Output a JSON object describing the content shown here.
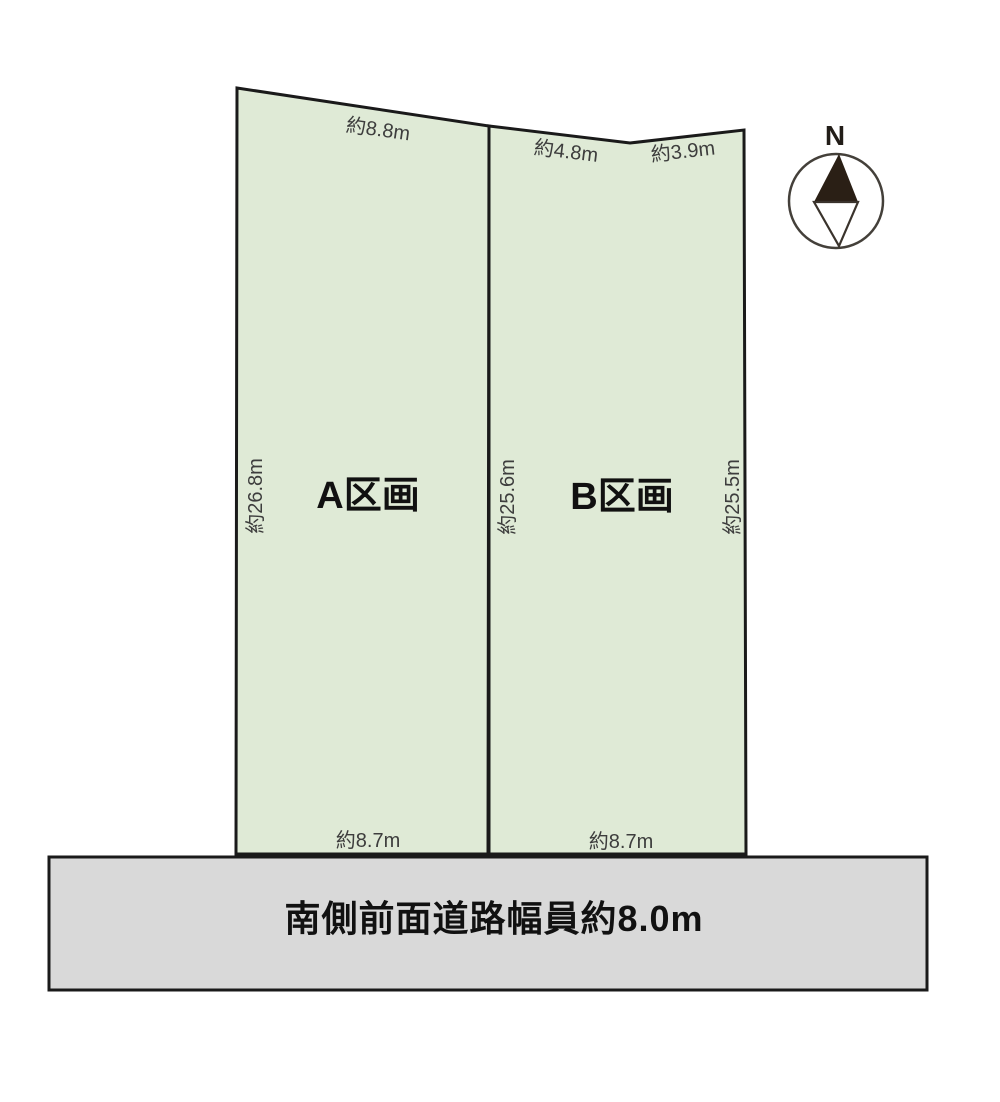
{
  "parcels": {
    "a": {
      "label": "A区画",
      "dim_top": "約8.8m",
      "dim_left": "約26.8m",
      "dim_bottom": "約8.7m"
    },
    "b": {
      "label": "B区画",
      "dim_top_left": "約4.8m",
      "dim_top_right": "約3.9m",
      "dim_left": "約25.6m",
      "dim_right": "約25.5m",
      "dim_bottom": "約8.7m"
    }
  },
  "road": {
    "label": "南側前面道路幅員約8.0m"
  },
  "compass": {
    "label": "N"
  },
  "colors": {
    "parcel_fill": "#dfead6",
    "road_fill": "#d9d9d9",
    "outline": "#1a1a1a",
    "needle_fill": "#2a1f15"
  }
}
